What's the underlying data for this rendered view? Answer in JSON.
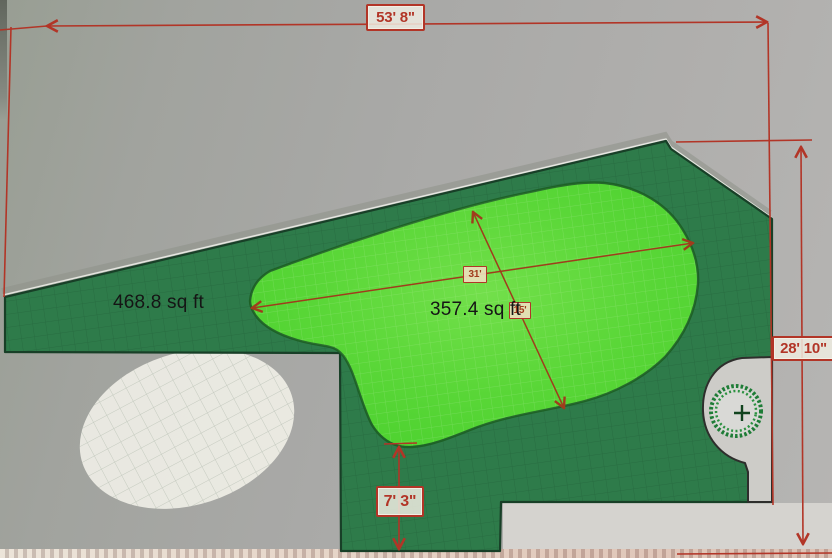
{
  "plan": {
    "areas": [
      {
        "name": "turf-area",
        "area_label": "468.8 sq ft",
        "color": "#2e7b4a"
      },
      {
        "name": "putting-green",
        "area_label": "357.4 sq ft",
        "color": "#4ed230"
      }
    ],
    "dimensions": [
      {
        "name": "overall-width",
        "label": "53' 8\""
      },
      {
        "name": "overall-height",
        "label": "28' 10\""
      },
      {
        "name": "green-edge-offset",
        "label": "7' 3\""
      },
      {
        "name": "green-length",
        "label": "31'"
      },
      {
        "name": "green-width",
        "label": "15'"
      }
    ],
    "symbols": [
      {
        "name": "tree-wreath-symbol"
      }
    ]
  },
  "theme": {
    "dimension_red": "#b23527",
    "inner_dimension_red": "#a03c1c",
    "label_box_bg": "#eeece2",
    "turf_green": "#2e7b4a",
    "putting_green": "#4ed230",
    "area_text": "#151515"
  }
}
